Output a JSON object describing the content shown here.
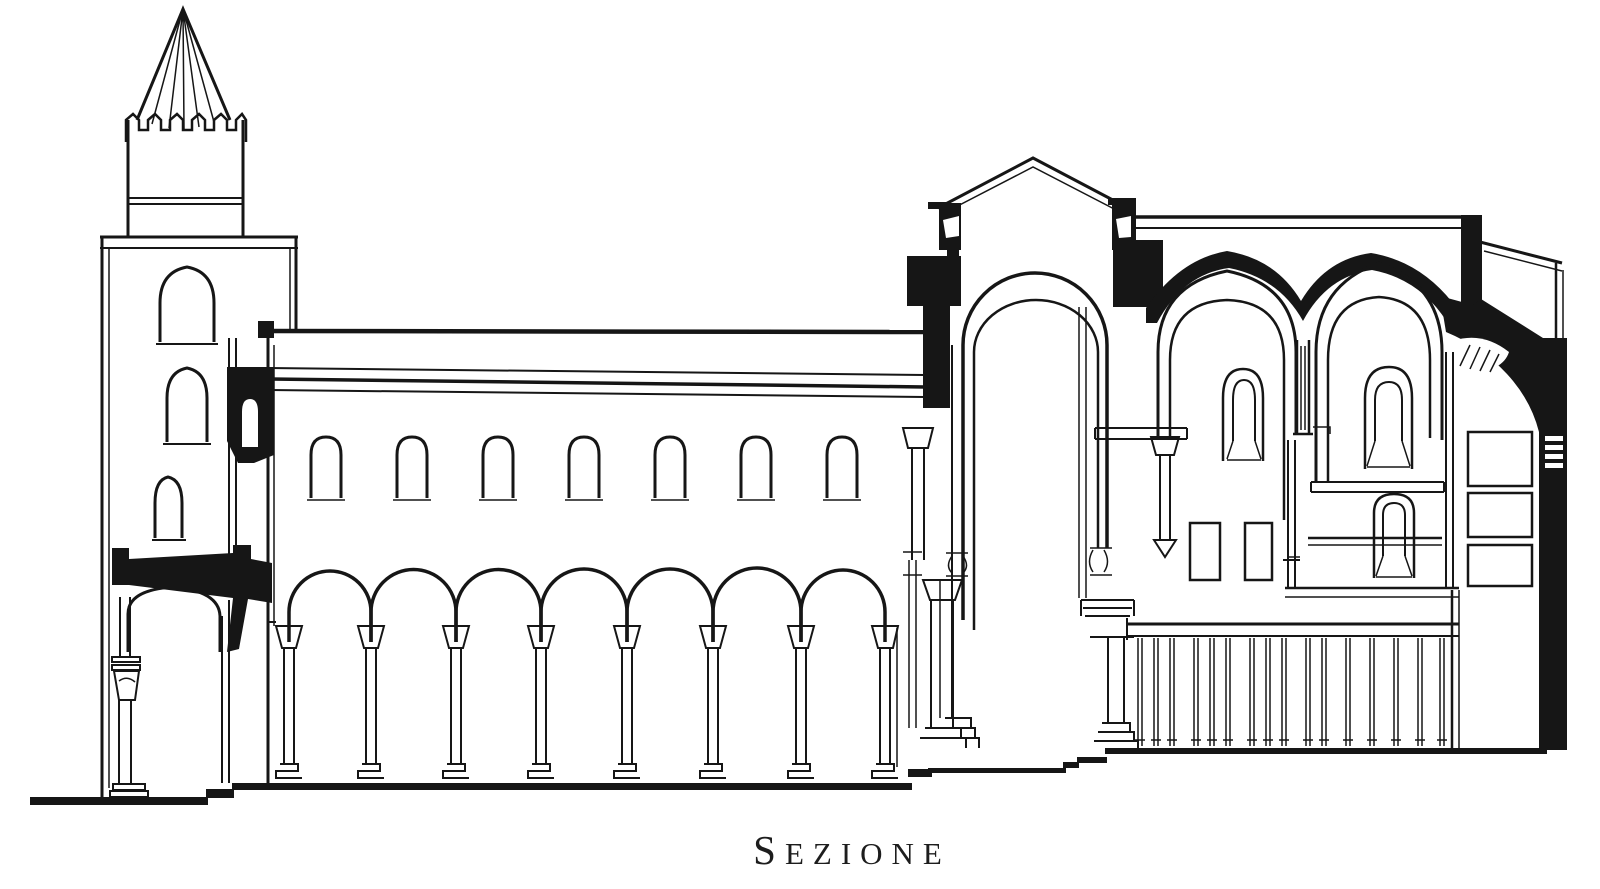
{
  "page": {
    "background": "#ffffff",
    "ink": "#161616",
    "caption_color": "#1d1d1d"
  },
  "caption": {
    "label": "SEZIONE"
  },
  "drawing": {
    "kind": "black-ink longitudinal section of a Romanesque cathedral",
    "clerestory_window_count": 7,
    "nave_arcade_arch_count": 7,
    "tower_window_count": 3,
    "choir_pointed_bay_count": 2,
    "balustrade_post_count": 16,
    "parts": [
      "bell-tower",
      "tower-spire",
      "tower-battlement",
      "tower-windows",
      "porch",
      "nave",
      "nave-roof",
      "clerestory-windows",
      "nave-arcade",
      "arcade-columns",
      "crossing",
      "crossing-gable",
      "crossing-arch",
      "crossing-piers",
      "choir",
      "choir-vault-band",
      "choir-pointed-arches",
      "choir-windows",
      "choir-niches",
      "tie-beams",
      "balustrade",
      "apse",
      "apse-conch",
      "right-wall",
      "stepped-floor"
    ]
  }
}
